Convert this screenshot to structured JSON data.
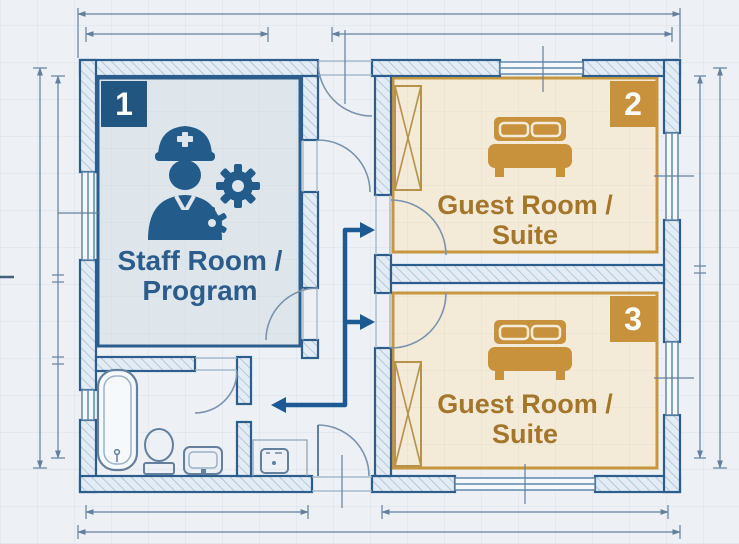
{
  "diagram": {
    "type": "floor-plan-blueprint",
    "rooms": [
      {
        "number": "1",
        "name": "staff-room",
        "lines": [
          "Staff Room /",
          "Program"
        ],
        "badge_color": "#20567f",
        "fill": "#dee6ec",
        "border": "#2c5d8c",
        "text_color": "#2b5c8c",
        "icon": "staff-person-with-gears-icon"
      },
      {
        "number": "2",
        "name": "guest-room-suite-2",
        "lines": [
          "Guest Room /",
          "Suite"
        ],
        "badge_color": "#c8923c",
        "fill": "#f3ead7",
        "border": "#c8963f",
        "text_color": "#a3762c",
        "icon": "double-bed-icon"
      },
      {
        "number": "3",
        "name": "guest-room-suite-3",
        "lines": [
          "Guest Room /",
          "Suite"
        ],
        "badge_color": "#c8923c",
        "fill": "#f3ead7",
        "border": "#c8963f",
        "text_color": "#a3762c",
        "icon": "double-bed-icon"
      }
    ],
    "fixtures": [
      "bathtub",
      "toilet",
      "sink",
      "washer",
      "wardrobe-room-2",
      "wardrobe-room-3"
    ],
    "flow_arrows": [
      "corridor-to-guest-room-2",
      "corridor-to-guest-room-3",
      "corridor-to-bathroom-area"
    ],
    "colors": {
      "background": "#edf1f6",
      "wall_line": "#2c5d8c",
      "wall_hatch_fill": "#e3ecf4",
      "hatch_line": "#a9bfd2",
      "dimension_line": "#64809d",
      "flow_arrow": "#1d5a94",
      "guest_accent": "#c8923c",
      "staff_accent": "#20567f"
    }
  }
}
